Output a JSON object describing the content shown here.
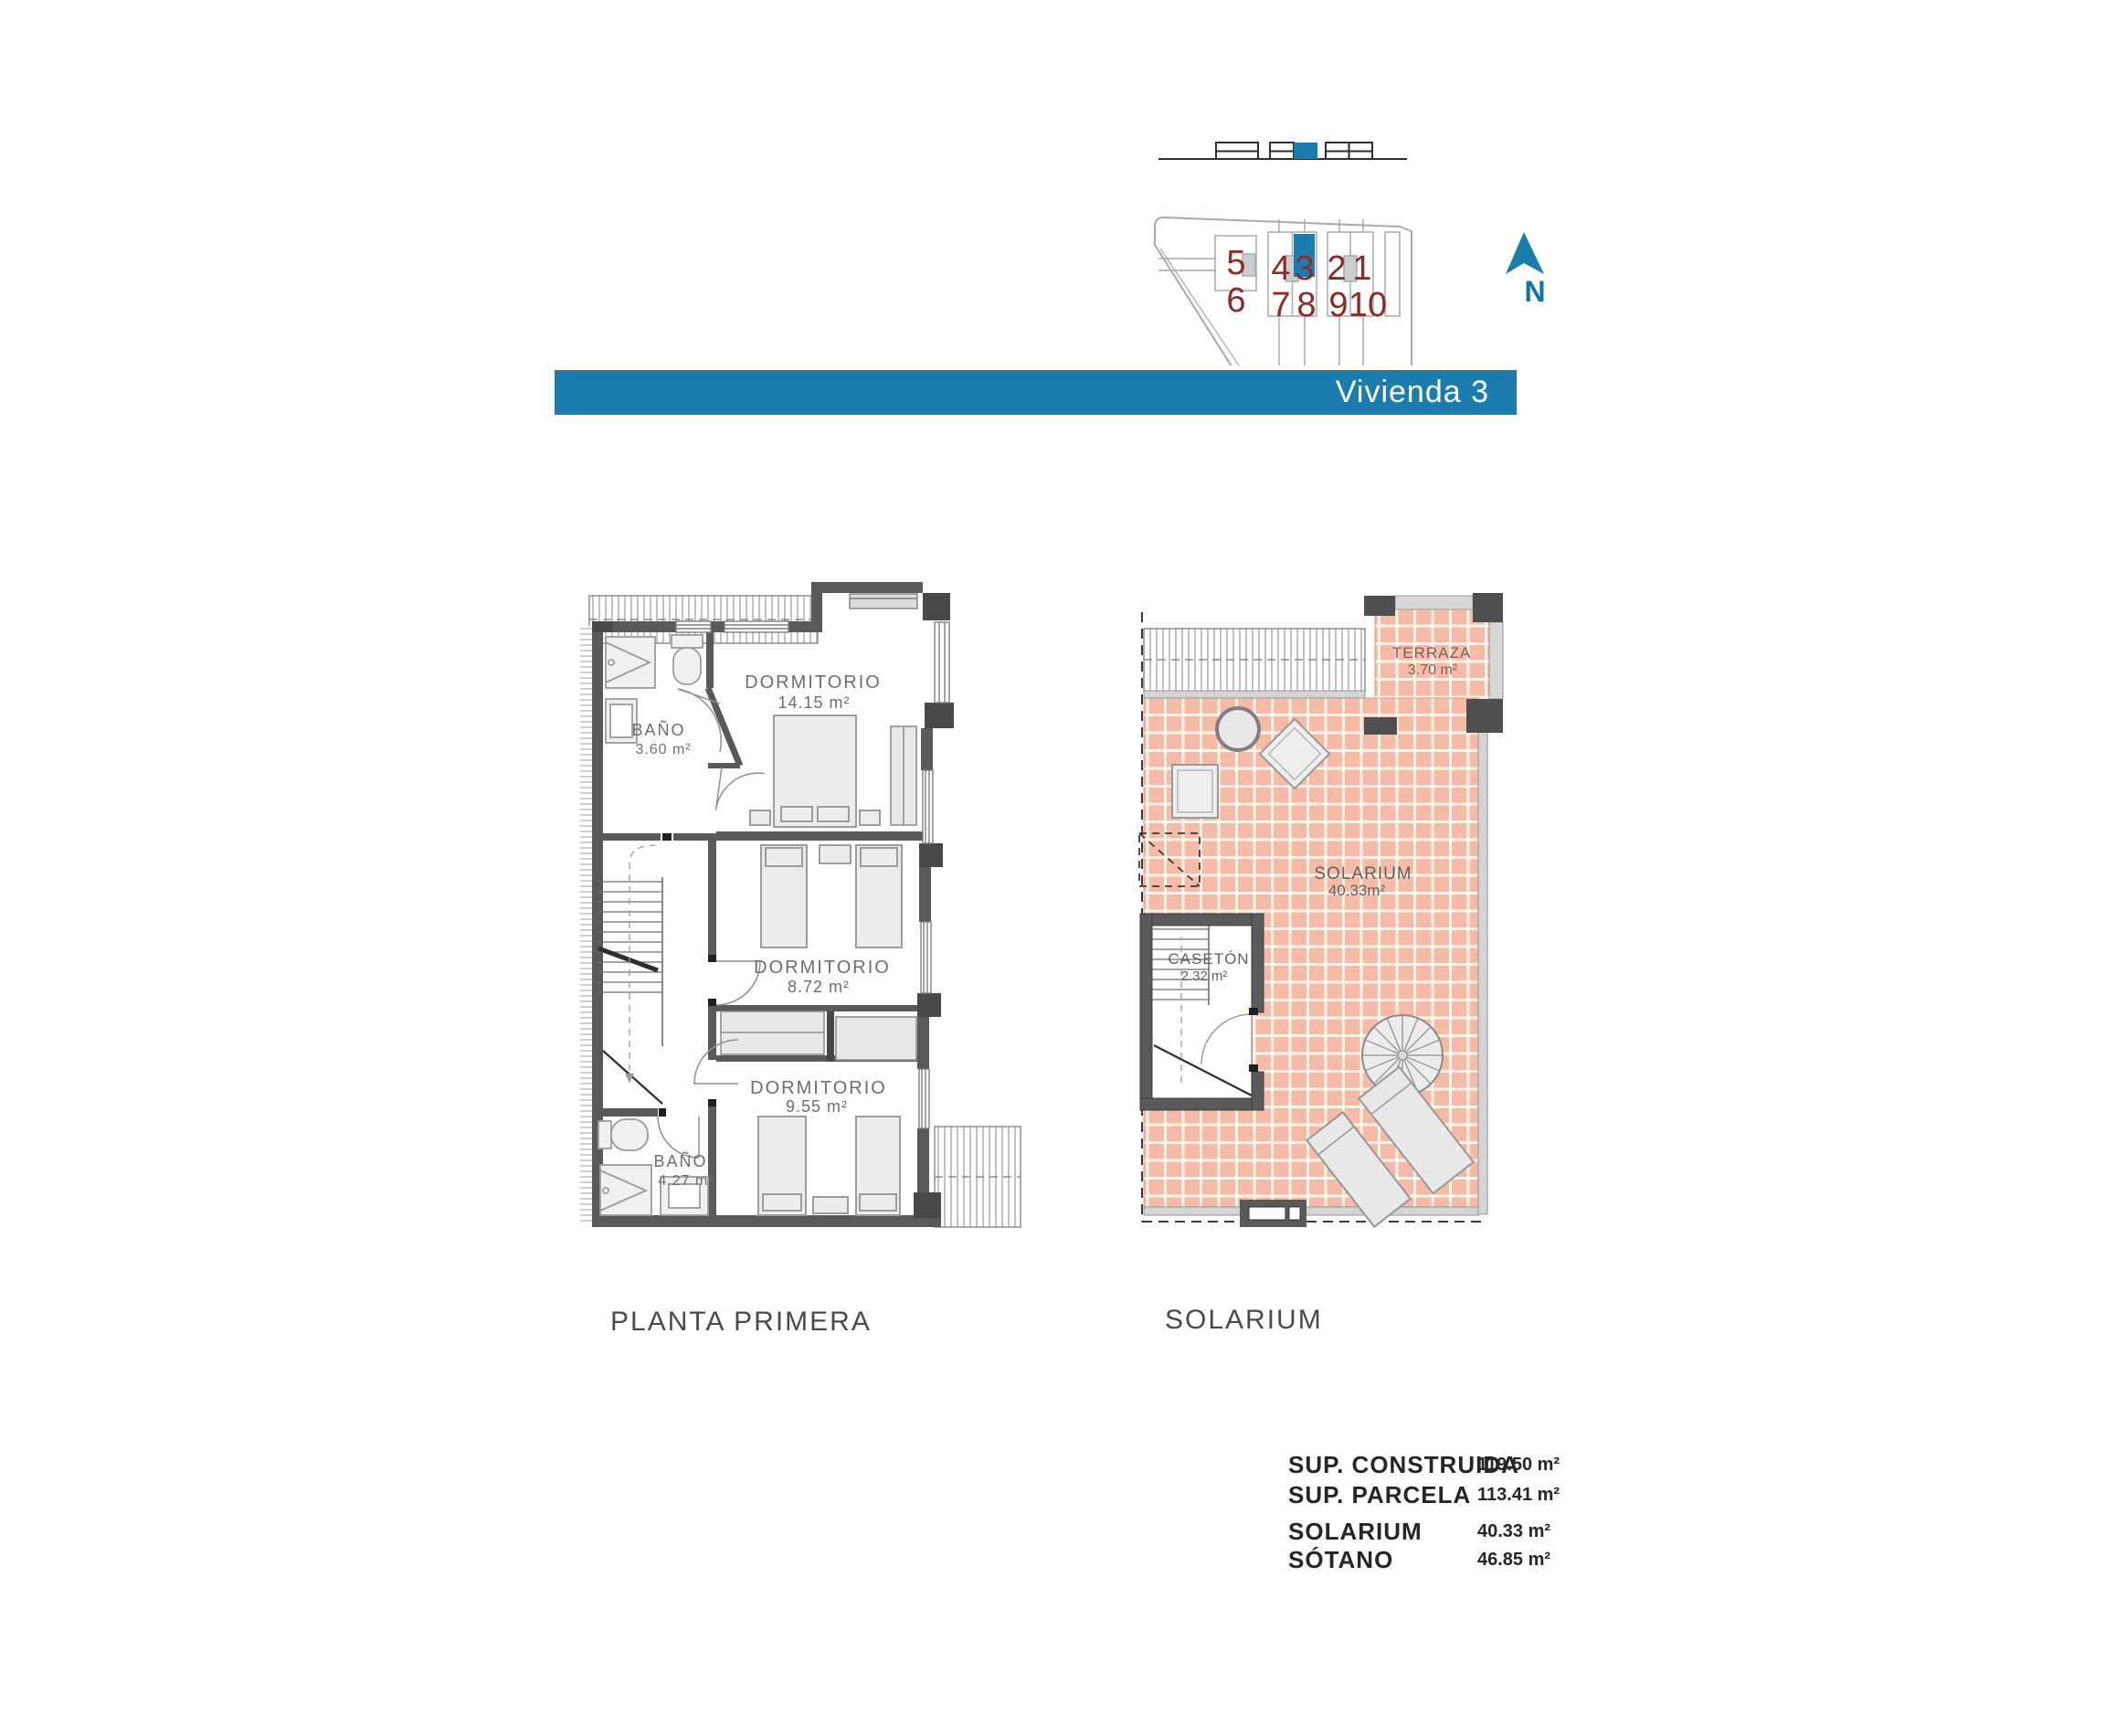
{
  "title_bar": {
    "label": "Vivienda 3",
    "color": "#1b7cae"
  },
  "site_plan": {
    "units": [
      "5",
      "6",
      "4",
      "3",
      "2",
      "1",
      "7",
      "8",
      "9",
      "10"
    ],
    "highlighted_unit": "3",
    "north_label": "N",
    "number_color": "#8e2a28",
    "highlight_color": "#1b7cae"
  },
  "plans": {
    "planta_primera": {
      "caption": "PLANTA PRIMERA",
      "rooms": [
        {
          "name": "BAÑO",
          "area": "3.60 m²"
        },
        {
          "name": "DORMITORIO",
          "area": "14.15 m²"
        },
        {
          "name": "DORMITORIO",
          "area": "8.72 m²"
        },
        {
          "name": "DORMITORIO",
          "area": "9.55 m²"
        },
        {
          "name": "BAÑO",
          "area": "4.27 m²"
        }
      ]
    },
    "solarium": {
      "caption": "SOLARIUM",
      "rooms": [
        {
          "name": "TERRAZA",
          "area": "3.70 m²"
        },
        {
          "name": "SOLARIUM",
          "area": "40.33m²"
        },
        {
          "name": "CASETÓN",
          "area": "2.32 m²"
        }
      ]
    }
  },
  "summary": {
    "rows": [
      {
        "label": "SUP. CONSTRUIDA",
        "value": "119.50 m²"
      },
      {
        "label": "SUP. PARCELA",
        "value": "113.41 m²"
      },
      {
        "label": "SOLARIUM",
        "value": "40.33 m²"
      },
      {
        "label": "SÓTANO",
        "value": "46.85 m²"
      }
    ]
  }
}
